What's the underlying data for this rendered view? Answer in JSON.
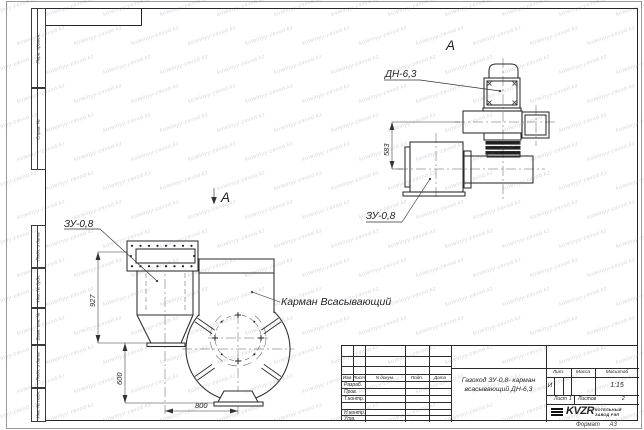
{
  "sheet": {
    "format_label": "Формат",
    "format_value": "А3"
  },
  "frame": {
    "margin_labels": [
      "Перв. примен.",
      "Справ. №",
      "Подп. и дата",
      "Инв. № дубл.",
      "Взам. инв. №",
      "Подп. и дата",
      "Инв. № подл."
    ]
  },
  "watermark": {
    "text": "kotelnyy-zavod.kz"
  },
  "views": {
    "aux": {
      "view_label": "А",
      "dn_label": "ДН-6,3",
      "zu_label": "ЗУ-0,8",
      "dim_h": "583"
    },
    "main": {
      "view_arrow_label": "А",
      "zu_label": "ЗУ-0,8",
      "pocket_label": "Карман Всасывающий",
      "dim_h1": "927",
      "dim_h2": "600",
      "dim_w": "800"
    }
  },
  "title_block": {
    "cols": [
      "Изм.",
      "Лист",
      "N докум.",
      "Подп.",
      "Дата"
    ],
    "rows": [
      "Разраб.",
      "Пров.",
      "Т.контр.",
      "Н.контр.",
      "Утв."
    ],
    "title_line1": "Газоход ЗУ-0,8- карман",
    "title_line2": "всасывающий ДН-6,3",
    "lit_header": "Лит.",
    "lit_value": "И",
    "mass_header": "Масса",
    "scale_header": "Масштаб",
    "scale_value": "1:15",
    "sheet_label": "Лист",
    "sheet_value": "1",
    "sheets_label": "Листов",
    "sheets_value": "2",
    "logo_text": "KVZR",
    "company_line1": "КОТЕЛЬНЫЙ",
    "company_line2": "ЗАВОД РЭП"
  }
}
